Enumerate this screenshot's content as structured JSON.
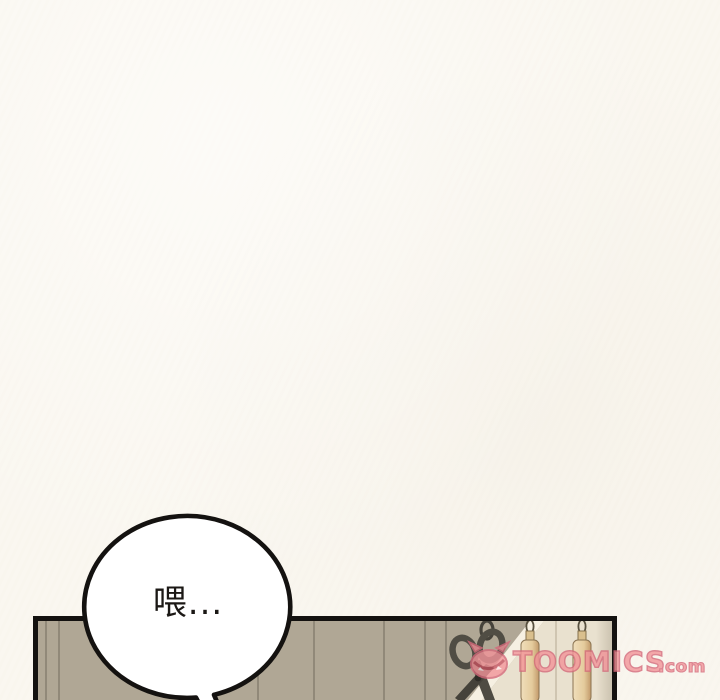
{
  "page": {
    "kind": "webtoon-comic-page",
    "background_color": "#faf7f0"
  },
  "speech_bubble": {
    "text": "喂...",
    "fill_color": "#ffffff",
    "outline_color": "#141210"
  },
  "panel": {
    "border_color": "#141210",
    "wall_color": "#b0a795",
    "wall_light_color": "#e9e1cf",
    "objects": [
      {
        "name": "hanging-scissors",
        "color": "#4e4b42"
      },
      {
        "name": "hanging-wooden-stick-left",
        "color": "#eedcb2"
      },
      {
        "name": "hanging-wooden-stick-right",
        "color": "#eedcb2"
      }
    ]
  },
  "watermark": {
    "brand": "TOOMICS",
    "suffix": ".com",
    "fill_color": "#f29499",
    "outline_color": "#d4697a"
  }
}
